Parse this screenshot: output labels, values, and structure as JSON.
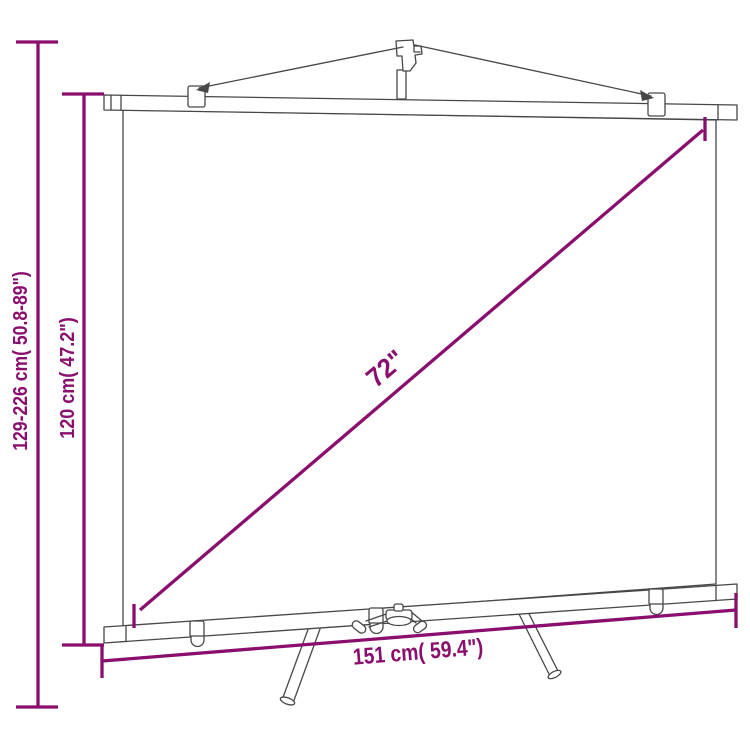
{
  "canvas": {
    "width": 750,
    "height": 750,
    "background": "#ffffff"
  },
  "colors": {
    "dimension": "#8a0e6e",
    "outline": "#474747",
    "fill": "#ffffff",
    "background": "#ffffff"
  },
  "subject": "tripod-projection-screen-dimension-diagram",
  "dimensions": {
    "total_height": "129-226 cm( 50.8-89\")",
    "screen_height": "120 cm( 47.2\")",
    "diagonal": "72\"",
    "width": "151 cm( 59.4\")"
  }
}
